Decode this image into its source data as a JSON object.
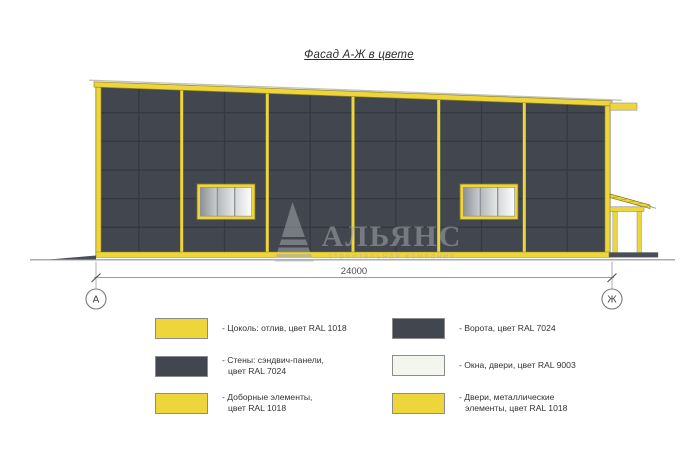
{
  "title": "Фасад А-Ж в цвете",
  "drawing": {
    "dimension_label": "24000",
    "axis_left_label": "А",
    "axis_right_label": "Ж",
    "watermark_name": "АЛЬЯНС",
    "watermark_subtitle": "строительная компания"
  },
  "colors": {
    "yellow": "#eed53c",
    "yellowline": "#97891e",
    "wall": "#42474f",
    "joint": "#343941",
    "white9003": "#f3f6ef"
  },
  "legend": {
    "items": [
      {
        "color": "#eed53c",
        "line1": "- Цоколь: отлив, цвет RAL 1018",
        "line2": ""
      },
      {
        "color": "#42474f",
        "line1": "- Стены: сэндвич-панели,",
        "line2": "цвет RAL 7024"
      },
      {
        "color": "#eed53c",
        "line1": "- Доборные элементы,",
        "line2": "цвет RAL 1018"
      },
      {
        "color": "#42474f",
        "line1": "- Ворота, цвет RAL 7024",
        "line2": ""
      },
      {
        "color": "#f3f6ef",
        "line1": "- Окна, двери, цвет RAL 9003",
        "line2": ""
      },
      {
        "color": "#eed53c",
        "line1": "- Двери, металлические",
        "line2": "элементы, цвет RAL 1018"
      }
    ]
  }
}
